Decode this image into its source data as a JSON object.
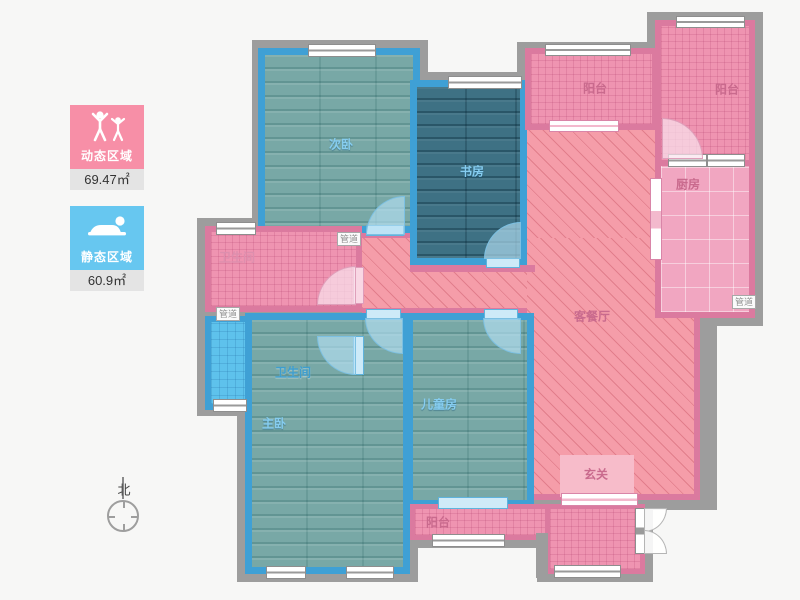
{
  "legend": {
    "dynamic": {
      "label": "动态区域",
      "area": "69.47㎡",
      "color": "#f78fa7",
      "icon": "people-active-icon"
    },
    "static": {
      "label": "静态区域",
      "area": "60.9㎡",
      "color": "#67c7f0",
      "icon": "person-resting-icon"
    }
  },
  "compass": {
    "north_label": "北"
  },
  "rooms": {
    "secondary_bedroom": "次卧",
    "study": "书房",
    "balcony_top_middle": "阳台",
    "balcony_top_right": "阳台",
    "kitchen": "厨房",
    "bathroom_upper": "卫生间",
    "bathroom_lower": "卫生间",
    "living_dining": "客餐厅",
    "entry_hall": "玄关",
    "master_bedroom": "主卧",
    "kids_room": "儿童房",
    "balcony_bottom": "阳台",
    "duct_left": "管道",
    "duct_middle": "管道",
    "duct_kitchen": "管道"
  },
  "colors": {
    "wall_gray": "#9d9d9d",
    "wall_blue": "#3fa0d5",
    "wall_pink": "#db7a9f",
    "floor_wood": "#78a8a6",
    "floor_wood_dark": "#3e7184",
    "floor_tile_pink": "#ef94b1",
    "floor_tile_blue": "#5ec2ec",
    "floor_kitchen": "#f1a6c1",
    "floor_living_hatch": "#f59da9",
    "entry_hall_fill": "#f7bcca"
  }
}
